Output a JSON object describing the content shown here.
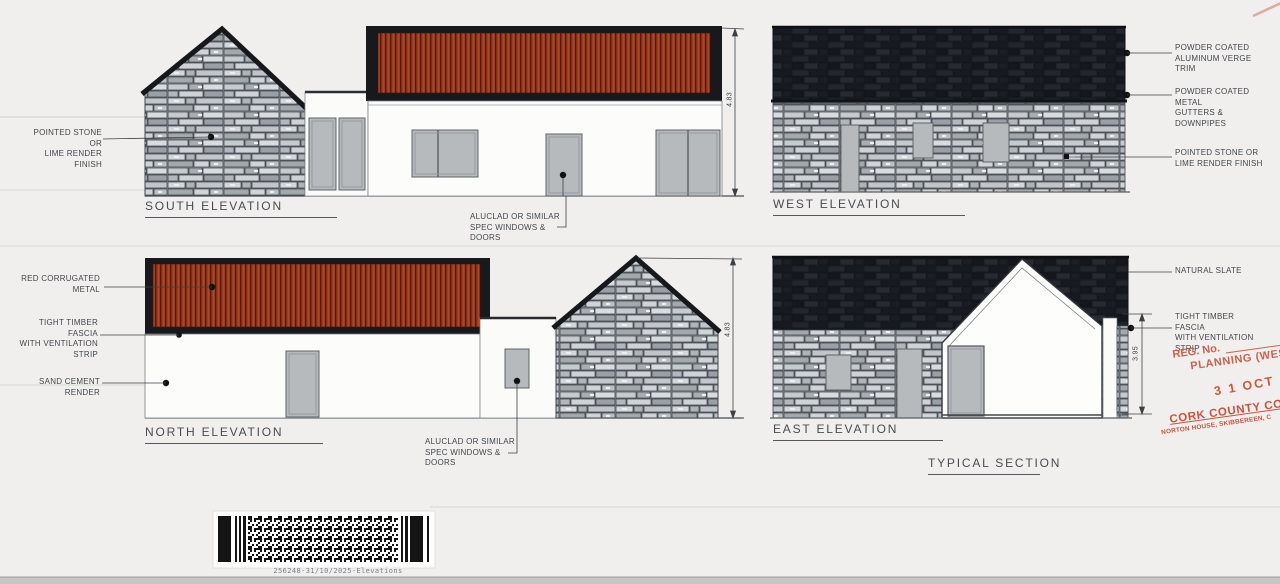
{
  "document_type": "scanned architectural elevations drawing",
  "elevations": {
    "south": {
      "title": "SOUTH ELEVATION",
      "height_dim": "4.83",
      "label_stone": "POINTED STONE OR\nLIME RENDER FINISH",
      "label_windows": "ALUCLAD OR SIMILAR\nSPEC WINDOWS &\nDOORS"
    },
    "west": {
      "title": "WEST ELEVATION",
      "label_verge": "POWDER COATED\nALUMINUM VERGE TRIM",
      "label_gutters": "POWDER COATED METAL\nGUTTERS & DOWNPIPES",
      "label_stone": "POINTED STONE OR\nLIME RENDER FINISH"
    },
    "north": {
      "title": "NORTH ELEVATION",
      "height_dim": "4.83",
      "label_roof": "RED CORRUGATED\nMETAL",
      "label_fascia": "TIGHT TIMBER FASCIA\nWITH VENTILATION\nSTRIP",
      "label_render": "SAND CEMENT RENDER",
      "label_windows": "ALUCLAD OR SIMILAR\nSPEC WINDOWS &\nDOORS"
    },
    "east": {
      "title": "EAST ELEVATION",
      "height_dim": "3.95",
      "label_slate": "NATURAL SLATE",
      "label_fascia": "TIGHT TIMBER FASCIA\nWITH VENTILATION\nSTRIP"
    },
    "section": {
      "title": "TYPICAL SECTION"
    }
  },
  "stamp": {
    "reg_label": "REG. No.",
    "dept": "PLANNING (WEST",
    "date": "3 1 OCT 2025",
    "council": "CORK COUNTY COUNC",
    "address": "NORTON HOUSE, SKIBBEREEN, C"
  },
  "barcode": {
    "caption": "256248-31/10/2025-Elevations"
  },
  "colors": {
    "paper": "#f1efed",
    "stone_base": "#7d8389",
    "slate_roof": "#1a1d23",
    "corrugated_red": "#9c3b20",
    "joinery_grey": "#b6babd",
    "drawing_line": "#3c4147",
    "stamp_red": "#cb5440"
  }
}
